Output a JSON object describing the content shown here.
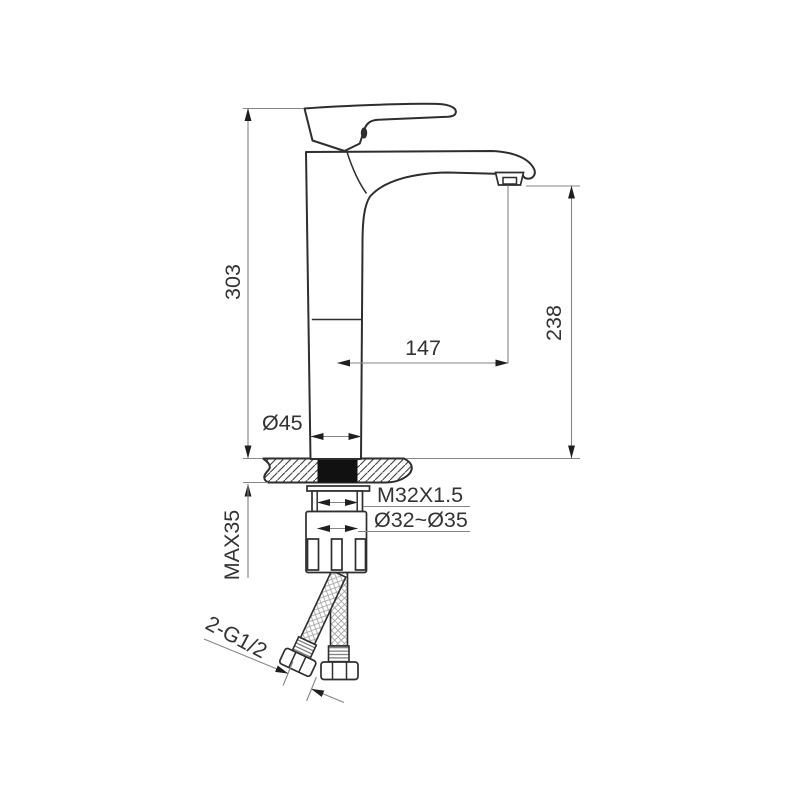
{
  "drawing": {
    "labels": {
      "overall_height": "303",
      "spout_height": "238",
      "spout_reach": "147",
      "body_diameter": "Ø45",
      "max_deck_thickness": "MAX35",
      "shank_thread": "M32X1.5",
      "mounting_hole_diameter": "Ø32~Ø35",
      "hose_thread": "2-G1/2"
    },
    "colors": {
      "background": "#ffffff",
      "outline": "#2e2e2e",
      "dimension_line": "#868686",
      "arrow": "#1f1f1f",
      "text": "#333333",
      "centerline": "#a9adb0",
      "shank_fill": "#111111"
    }
  }
}
